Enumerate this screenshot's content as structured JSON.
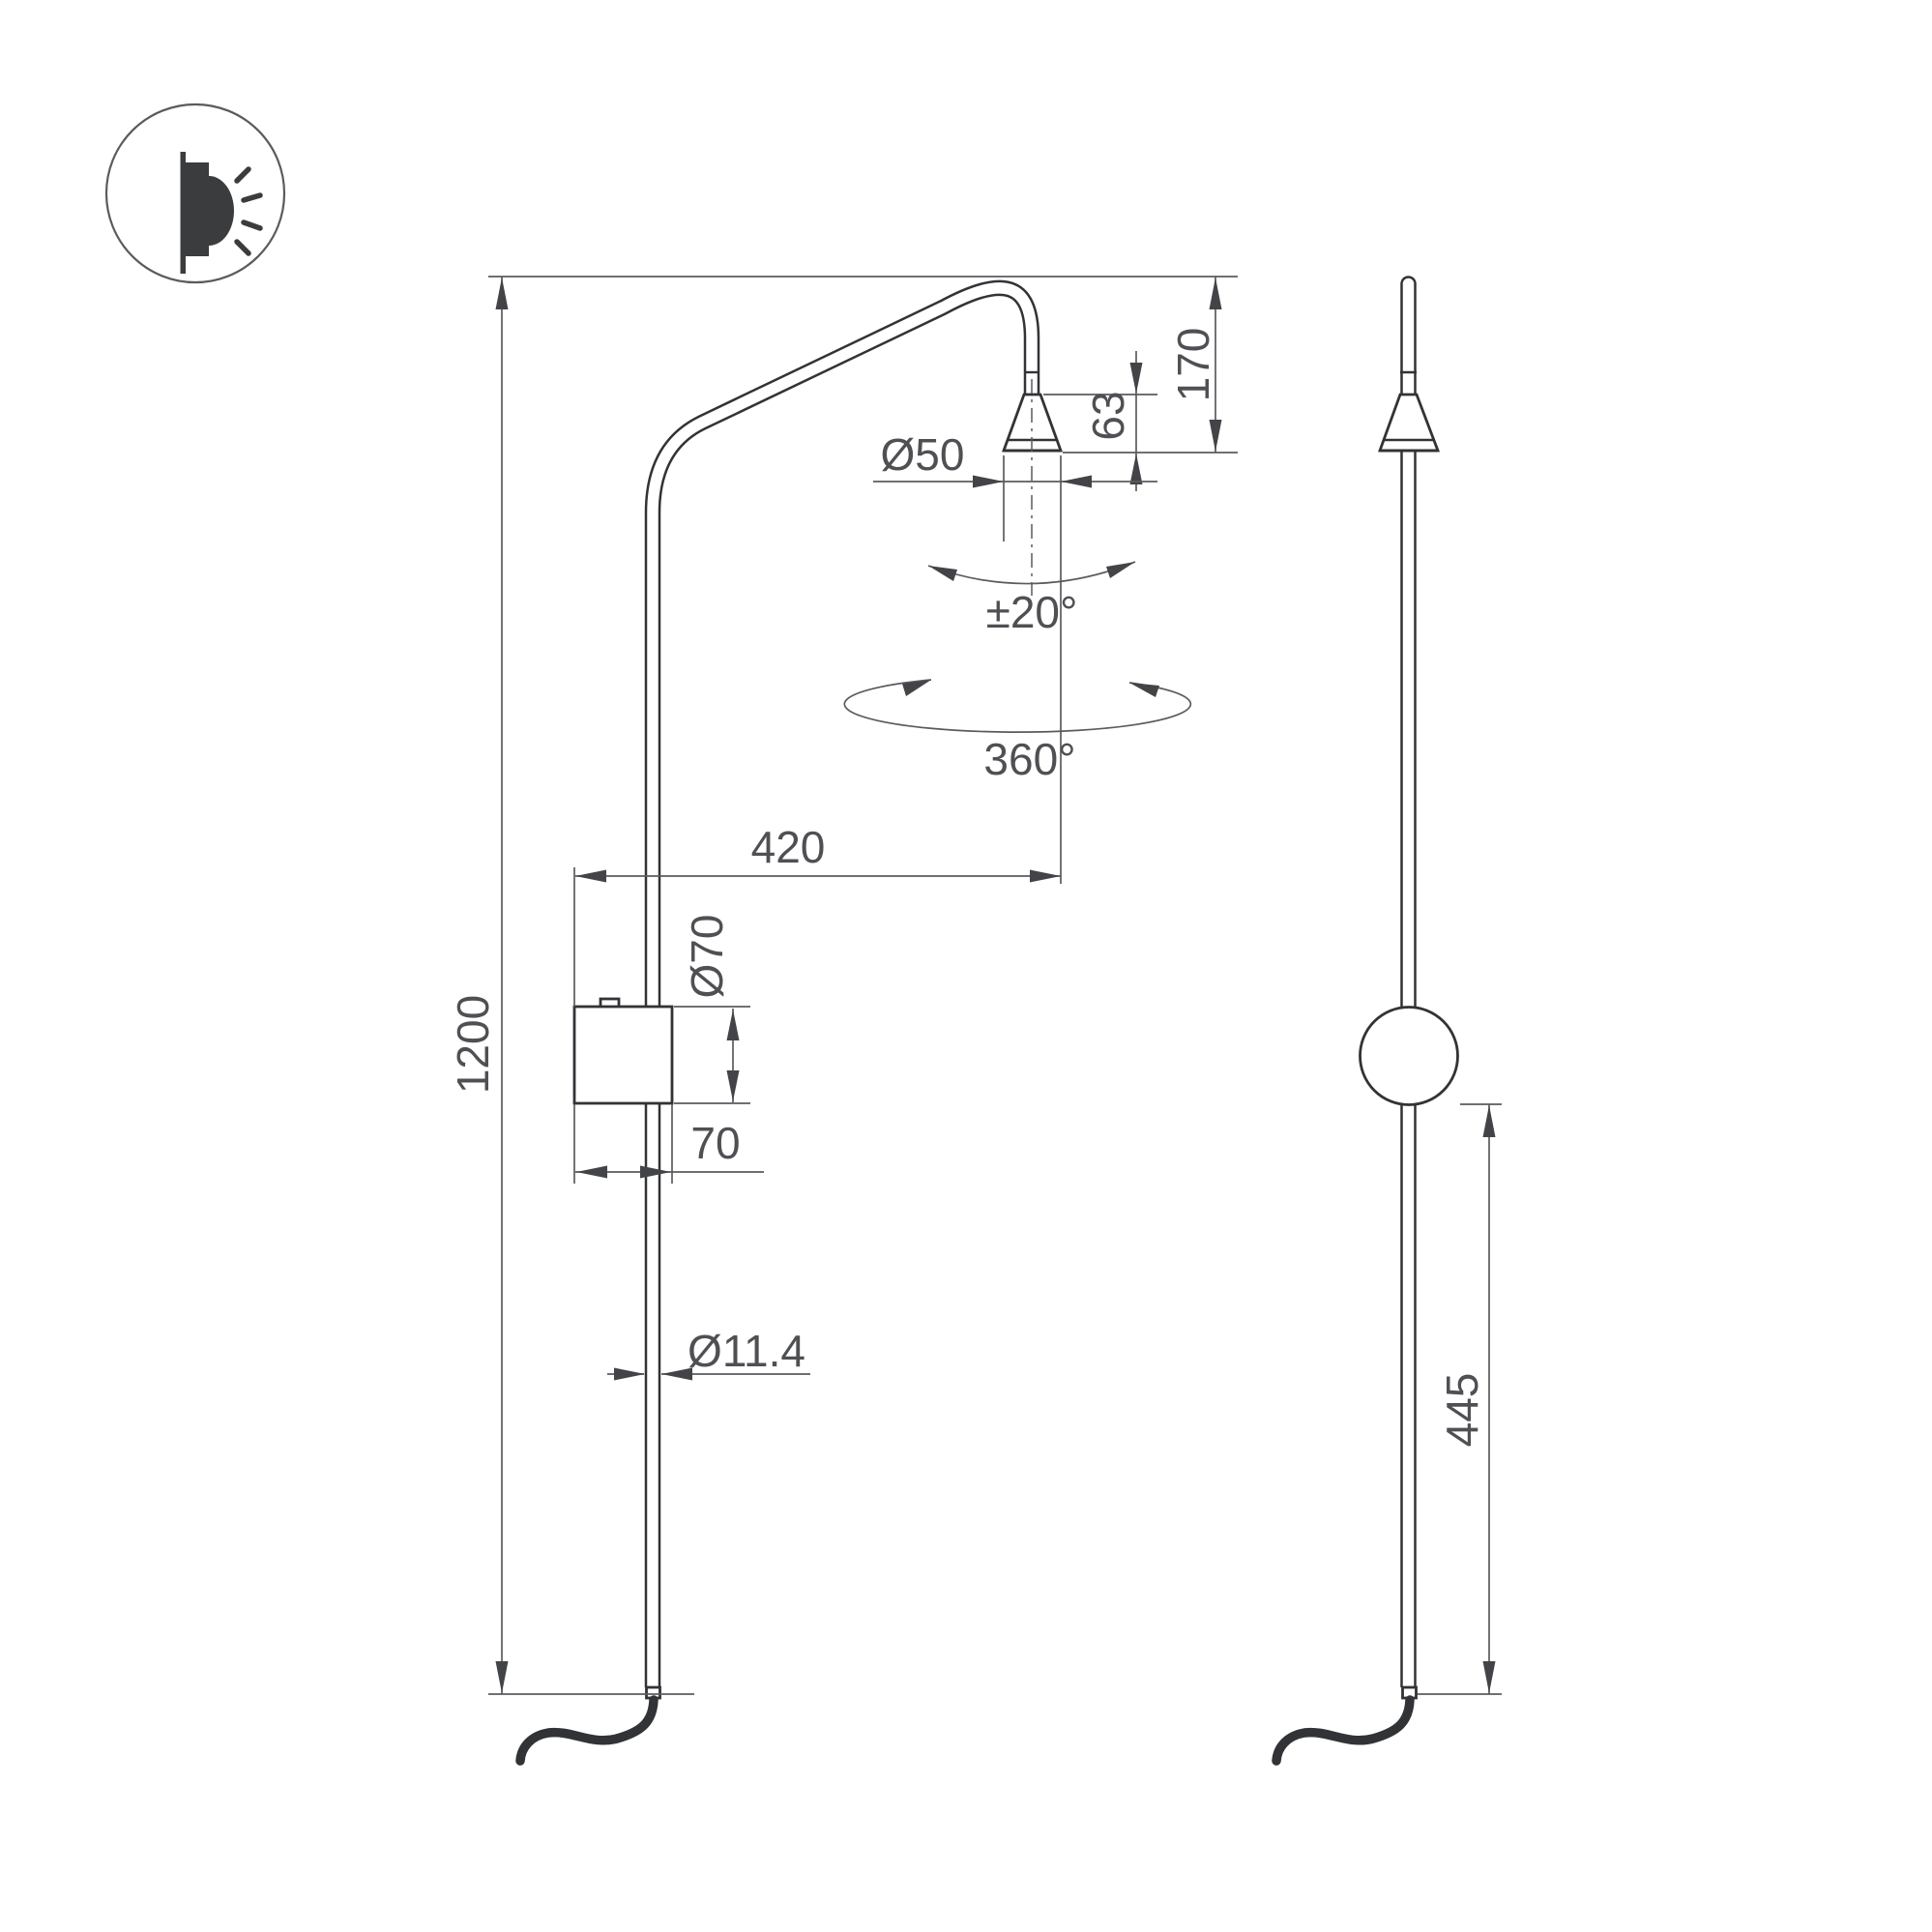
{
  "icon": {
    "name": "wall-lamp-glow-icon"
  },
  "dimensions": {
    "overall_height": "1200",
    "projection": "420",
    "head_offset": "170",
    "cone_height": "63",
    "cone_diameter": "Ø50",
    "tilt_range": "±20°",
    "rotation": "360°",
    "box_diameter": "Ø70",
    "box_width": "70",
    "tube_diameter": "Ø11.4",
    "box_to_bottom": "445"
  },
  "colors": {
    "bg": "#ffffff",
    "line": "#323336",
    "dim": "#5a5b5f",
    "text": "#4f5054",
    "arrow": "#434448"
  }
}
